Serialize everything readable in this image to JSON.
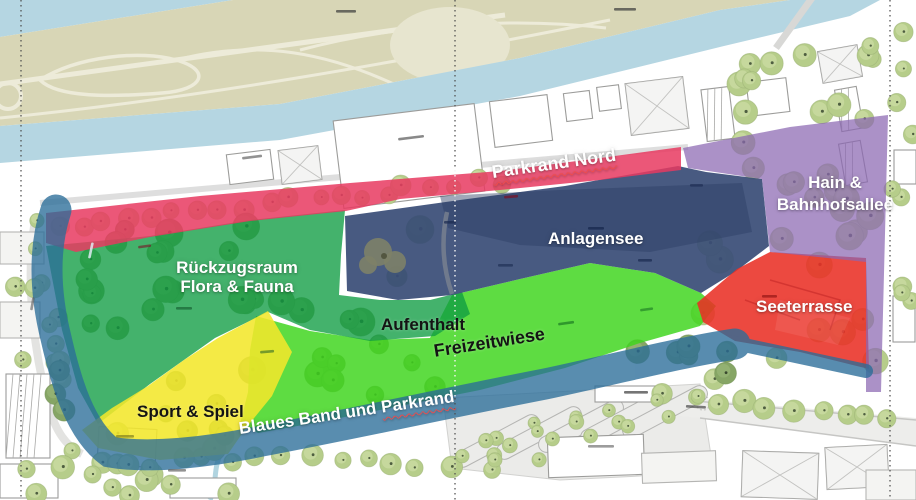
{
  "map": {
    "zones": {
      "parkrand_nord": {
        "label": "Parkrand Nord",
        "color": "#e73a60",
        "underline": "red-squiggle"
      },
      "anlagensee": {
        "label": "Anlagensee",
        "color": "#3a4e77"
      },
      "hain_bahnhofsallee": {
        "line1": "Hain &",
        "line2": "Bahnhofsallee",
        "color": "#8a66b2"
      },
      "rueckzugsraum": {
        "line1": "Rückzugsraum",
        "line2": "Flora & Fauna",
        "color": "#0f9c43"
      },
      "aufenthalt": {
        "label": "Aufenthalt",
        "color": "#0f9c43"
      },
      "freizeitwiese": {
        "label": "Freizeitwiese",
        "color": "#3fd51e"
      },
      "seeterrasse": {
        "label": "Seeterrasse",
        "color": "#e93026"
      },
      "sport_und_spiel": {
        "label": "Sport & Spiel",
        "color": "#f3e72b"
      },
      "blaues_band": {
        "part1": "Blaues Band und",
        "part2": "Parkrand",
        "color": "#2a6d99",
        "underline": "red-squiggle"
      }
    }
  }
}
